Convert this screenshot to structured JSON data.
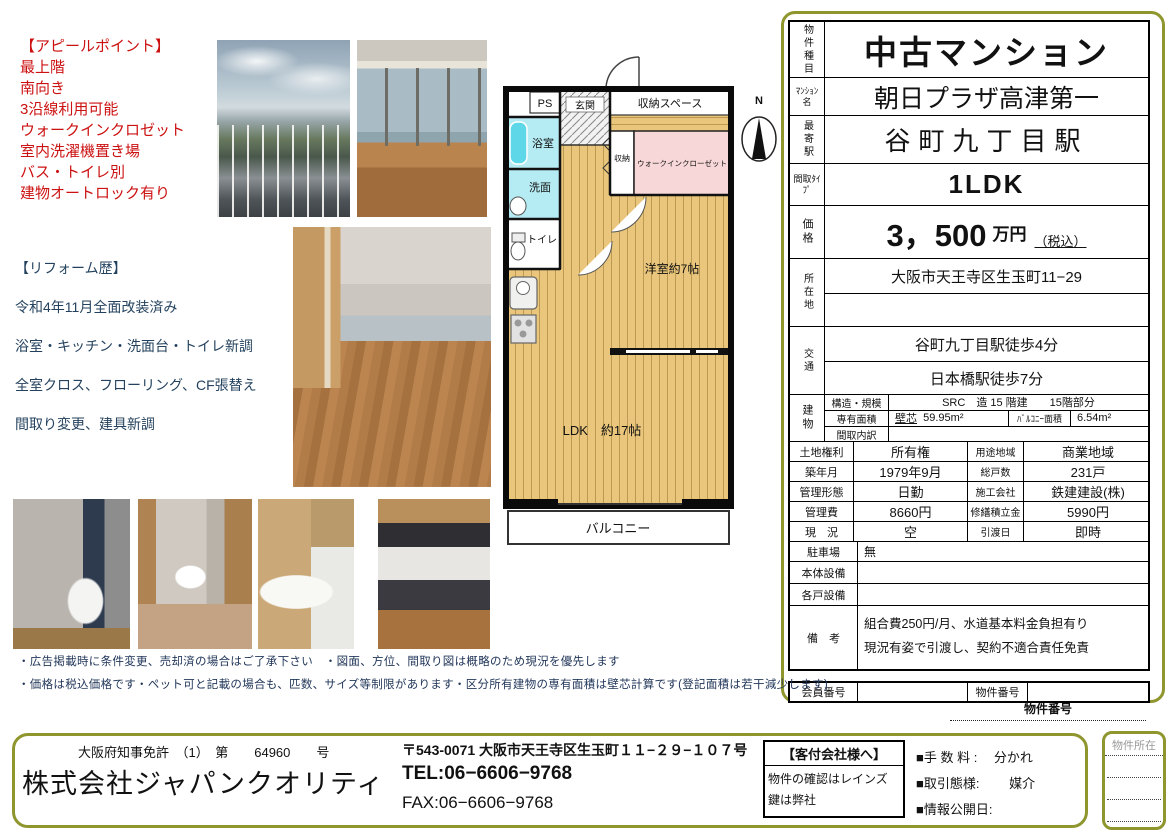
{
  "colors": {
    "accent_olive": "#8f962e",
    "appeal_red": "#cc1111",
    "reform_navy": "#24425e",
    "floor_wood": "#e9c67c",
    "floor_wet": "#b5ebf2",
    "floor_wic_pink": "#f7d7d7"
  },
  "appeal": {
    "title": "【アピールポイント】",
    "items": [
      "最上階",
      "南向き",
      "3沿線利用可能",
      "ウォークインクロゼット",
      "室内洗濯機置き場",
      "バス・トイレ別",
      "建物オートロック有り"
    ]
  },
  "reform": {
    "title": "【リフォーム歴】",
    "items": [
      "令和4年11月全面改装済み",
      "浴室・キッチン・洗面台・トイレ新調",
      "全室クロス、フローリング、CF張替え",
      "間取り変更、建具新調"
    ]
  },
  "floorplan": {
    "ps": "PS",
    "genkan": "玄関",
    "storage_space": "収納スペース",
    "bathroom": "浴室",
    "washroom": "洗面",
    "toilet": "トイレ",
    "closet": "収納",
    "walk_in_closet": "ウォークインクローゼット",
    "western_room": "洋室約7帖",
    "ldk": "LDK　約17帖",
    "balcony": "バルコニー",
    "compass_north": "N"
  },
  "spec": {
    "property_type_label": "物件種目",
    "property_type": "中古マンション",
    "mansion_name_label": "ﾏﾝｼｮﾝ名",
    "mansion_name": "朝日プラザ高津第一",
    "station_label": "最寄駅",
    "station": "谷町九丁目駅",
    "layout_label": "間取ﾀｲﾌﾟ",
    "layout": "1LDK",
    "price_label": "価格",
    "price": "3，500",
    "price_unit": "万円",
    "price_tax": "（税込）",
    "address_label": "所在地",
    "address": "大阪市天王寺区生玉町11−29",
    "access_label": "交通",
    "access1": "谷町九丁目駅徒歩4分",
    "access2": "日本橋駅徒歩7分",
    "building_label": "建物",
    "structure_label": "構造・規模",
    "structure": "SRC　造 15 階建　　15階部分",
    "area_label": "専有面積",
    "area_prefix": "壁芯",
    "area_value": "59.95m²",
    "balcony_area_label": "ﾊﾞﾙｺﾆｰ面積",
    "balcony_area": "6.54m²",
    "layout_detail_label": "間取内訳",
    "layout_detail": "",
    "pairs": [
      {
        "l1": "土地権利",
        "v1": "所有権",
        "l2": "用途地域",
        "v2": "商業地域"
      },
      {
        "l1": "築年月",
        "v1": "1979年9月",
        "l2": "総戸数",
        "v2": "231戸"
      },
      {
        "l1": "管理形態",
        "v1": "日勤",
        "l2": "施工会社",
        "v2": "鉄建建設(株)"
      },
      {
        "l1": "管理費",
        "v1": "8660円",
        "l2": "修繕積立金",
        "v2": "5990円"
      },
      {
        "l1": "現　況",
        "v1": "空",
        "l2": "引渡日",
        "v2": "即時"
      }
    ],
    "parking_label": "駐車場",
    "parking": "無",
    "main_equip_label": "本体設備",
    "main_equip": "",
    "unit_equip_label": "各戸設備",
    "unit_equip": "",
    "remarks_label": "備　考",
    "remarks1": "組合費250円/月、水道基本料金負担有り",
    "remarks2": "現況有姿で引渡し、契約不適合責任免責",
    "member_no_label": "会員番号",
    "member_no": "",
    "property_no_label": "物件番号",
    "property_no": ""
  },
  "notes": {
    "property_no_caption": "物件番号",
    "disclaimer1": "・広告掲載時に条件変更、売却済の場合はご了承下さい　・図面、方位、間取り図は概略のため現況を優先します",
    "disclaimer2": "・価格は税込価格です・ペット可と記載の場合も、匹数、サイズ等制限があります・区分所有建物の専有面積は壁芯計算です(登記面積は若干減少します)"
  },
  "footer": {
    "license": "大阪府知事免許　（1）　第　　64960　　号",
    "company": "株式会社ジャパンクオリティ",
    "address": "〒543-0071 大阪市天王寺区生玉町１１−２９−１０７号",
    "tel": "TEL:06−6606−9768",
    "fax": "FAX:06−6606−9768",
    "agent_title": "【客付会社様へ】",
    "agent_line1": "物件の確認はレインズ",
    "agent_line2": "鍵は弊社",
    "fee": "■手 数 料 :　 分かれ",
    "transaction": "■取引態様:　　 媒介",
    "publish_date": "■情報公開日:",
    "location_label": "物件所在"
  }
}
